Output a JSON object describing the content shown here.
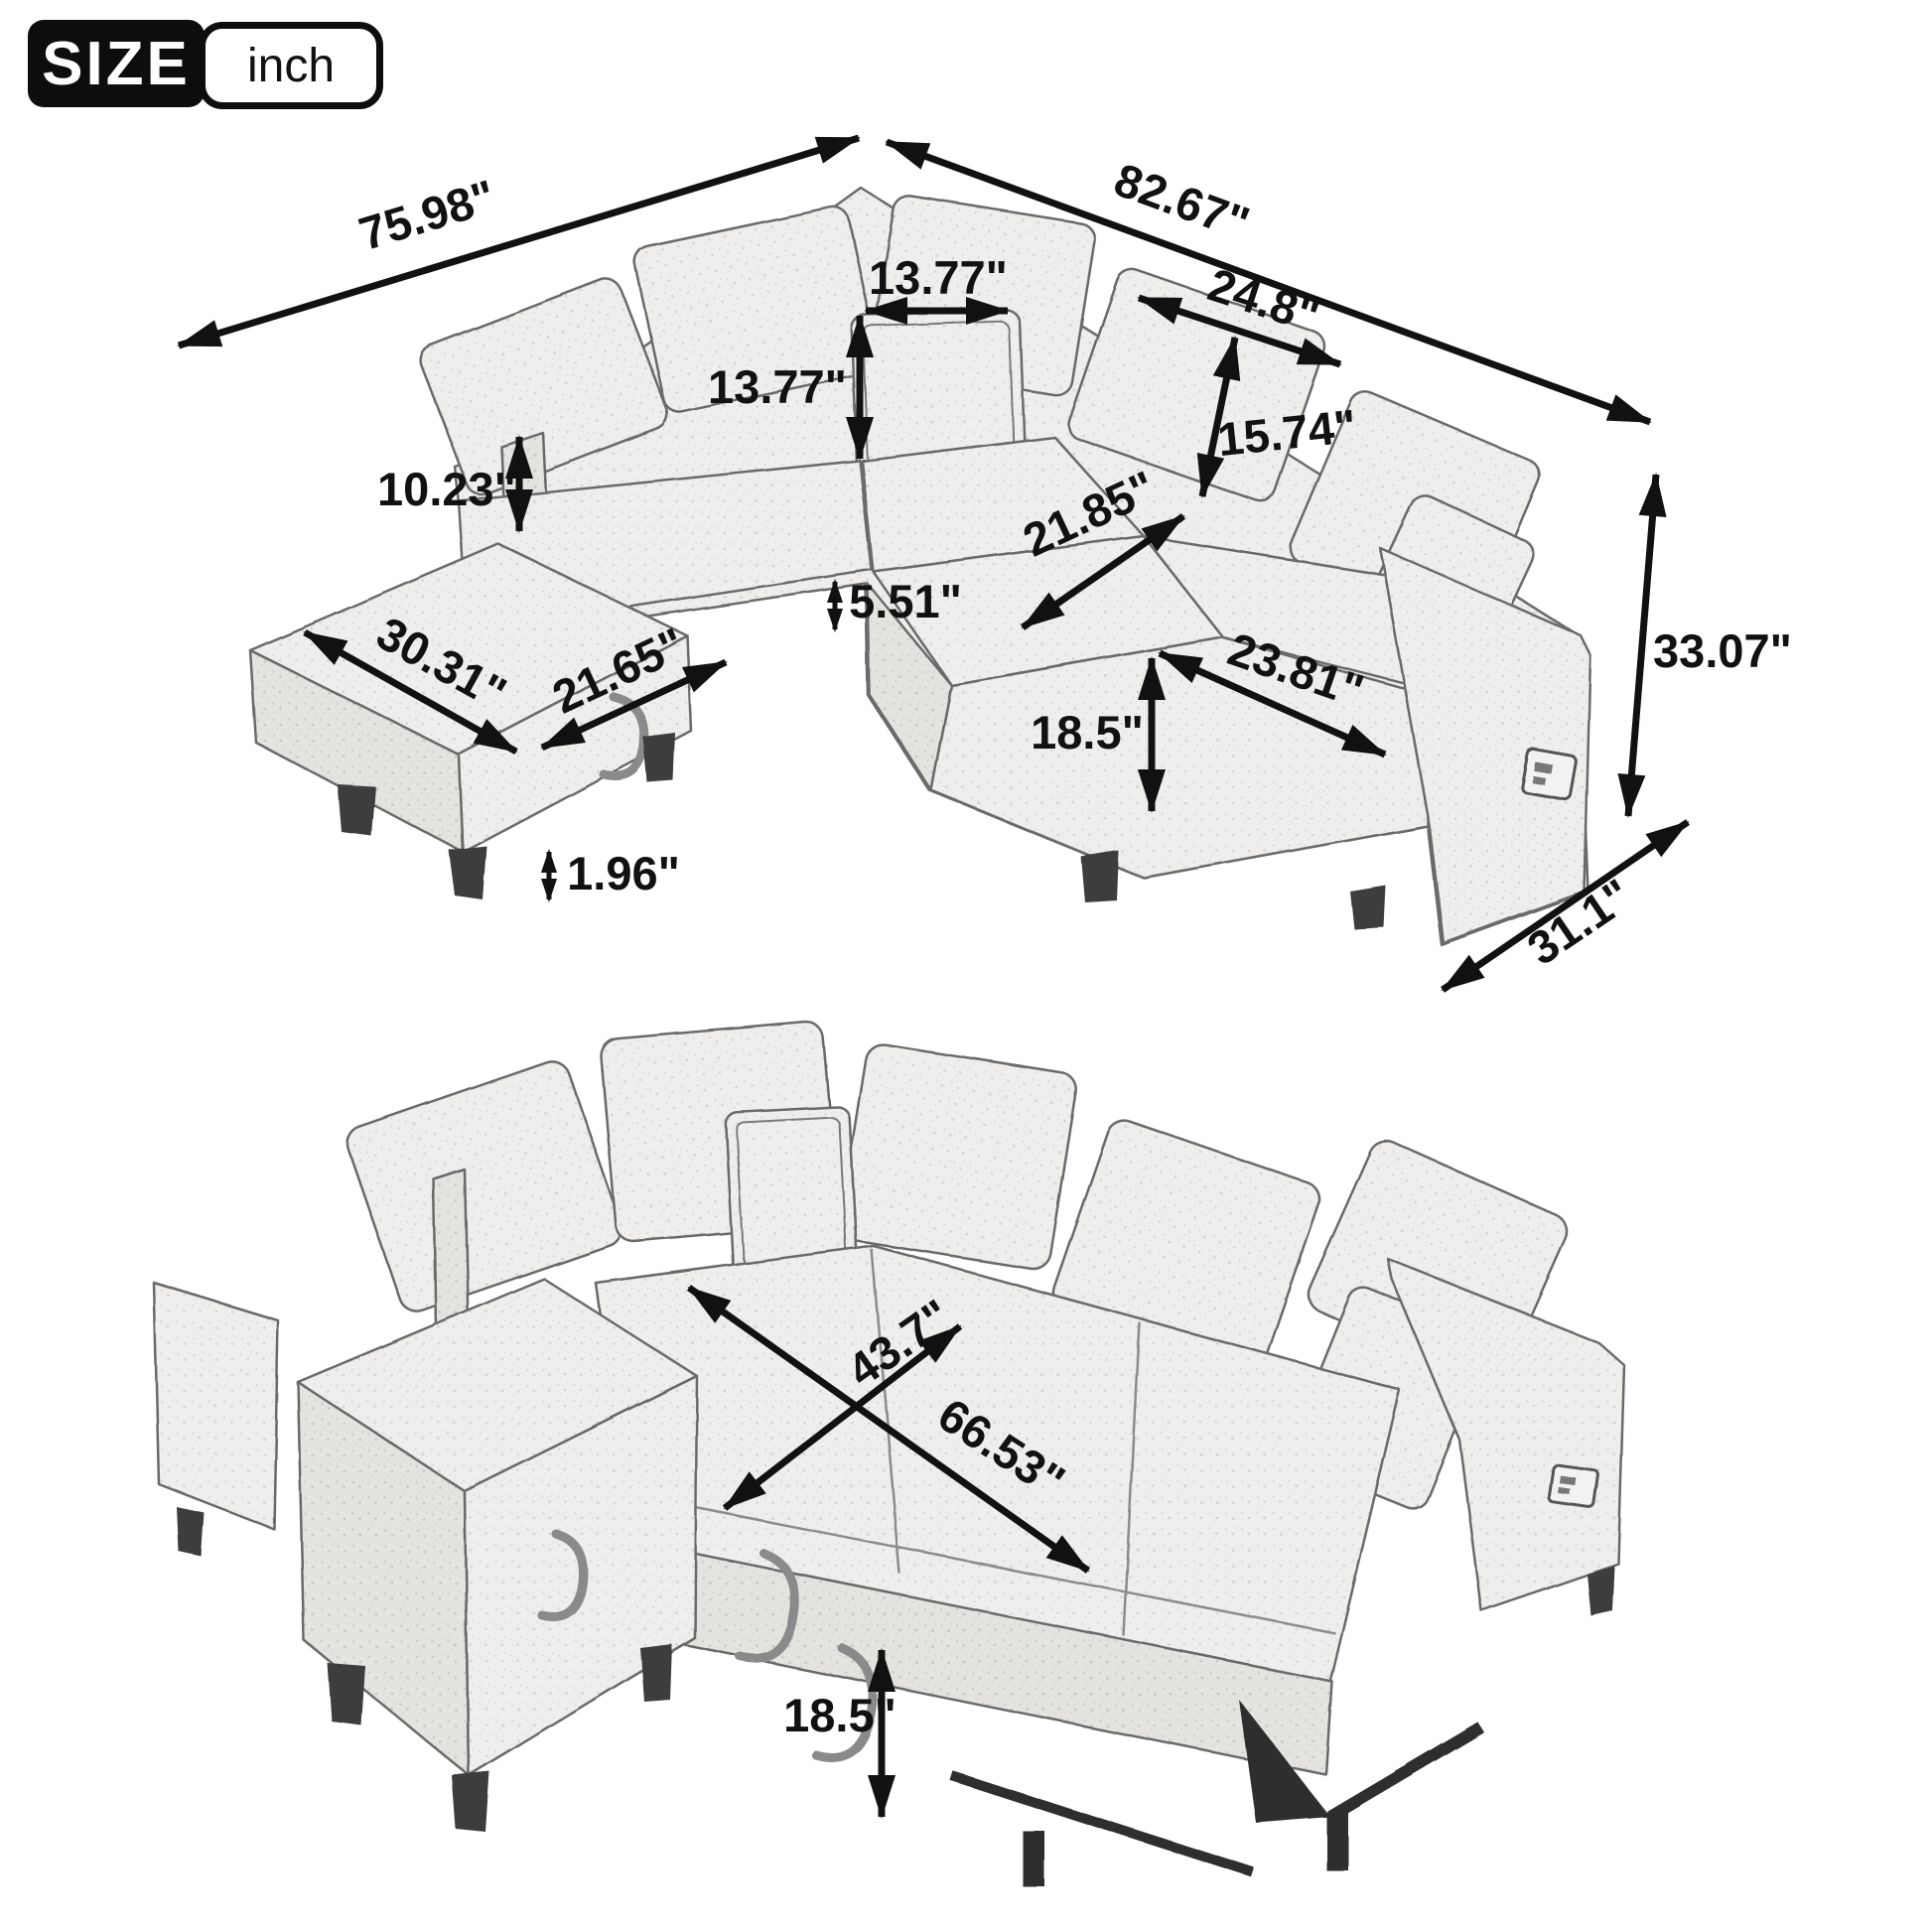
{
  "badge": {
    "label": "SIZE",
    "unit": "inch"
  },
  "colors": {
    "annotation": "#111111",
    "badge_bg": "#0d0d0d",
    "badge_text": "#ffffff",
    "sketch_line": "#6a6a6a",
    "fabric_light": "#efeeec",
    "fabric_shade": "#e4e3e0"
  },
  "dims": {
    "overall_width_left": "75.98\"",
    "overall_width_right": "82.67\"",
    "pillow_width": "13.77\"",
    "pillow_height": "13.77\"",
    "back_cushion_width": "24.8\"",
    "back_cushion_height": "15.74\"",
    "side_back_height": "10.23\"",
    "seat_depth": "21.85\"",
    "seat_cushion_thickness": "5.51\"",
    "ottoman_width": "30.31\"",
    "ottoman_depth": "21.65\"",
    "seat_width": "23.81\"",
    "seat_height": "18.5\"",
    "leg_height": "1.96\"",
    "overall_height": "33.07\"",
    "overall_depth": "31.1\"",
    "bed_width": "43.7\"",
    "bed_length": "66.53\"",
    "bed_height": "18.5\""
  }
}
